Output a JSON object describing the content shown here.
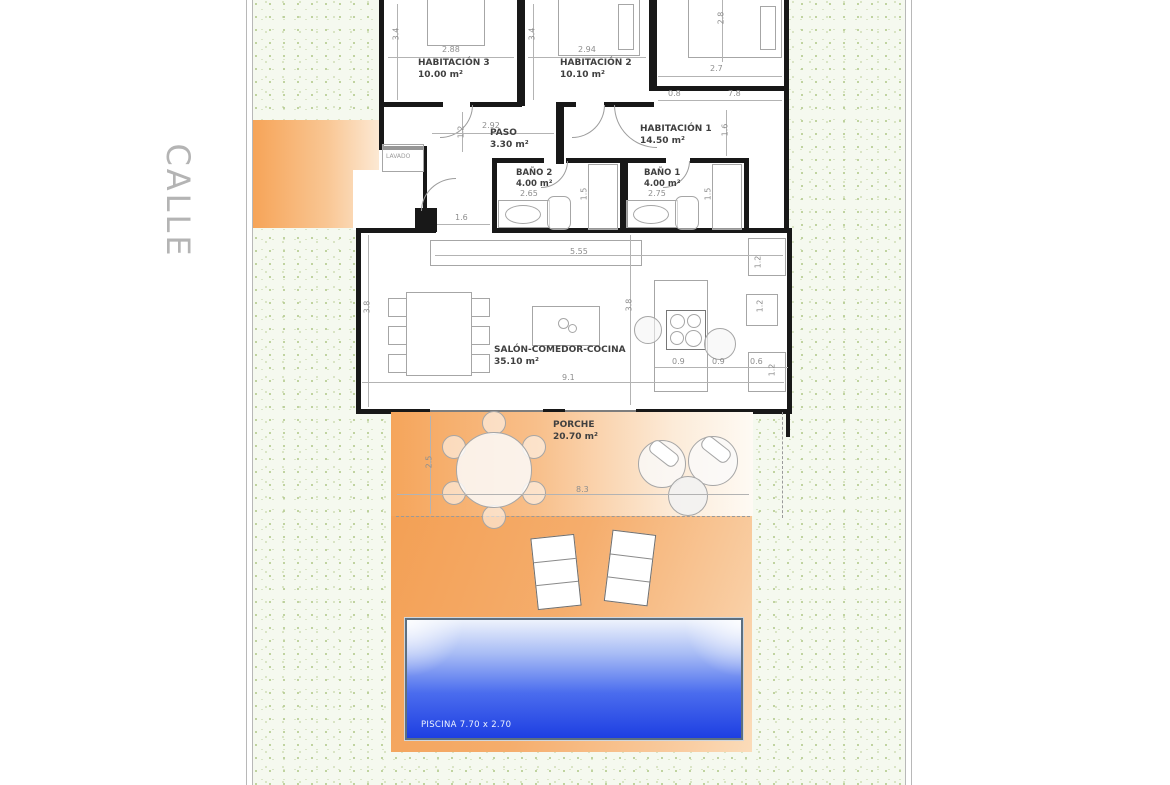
{
  "street": {
    "label": "CALLE"
  },
  "rooms": {
    "habitacion3": {
      "name": "HABITACIÓN 3",
      "area": "10.00 m²"
    },
    "habitacion2": {
      "name": "HABITACIÓN 2",
      "area": "10.10 m²"
    },
    "habitacion1": {
      "name": "HABITACIÓN 1",
      "area": "14.50 m²"
    },
    "paso": {
      "name": "PASO",
      "area": "3.30 m²"
    },
    "bano2": {
      "name": "BAÑO 2",
      "area": "4.00 m²"
    },
    "bano1": {
      "name": "BAÑO 1",
      "area": "4.00 m²"
    },
    "salon": {
      "name": "SALÓN-COMEDOR-COCINA",
      "area": "35.10 m²"
    },
    "porche": {
      "name": "PORCHE",
      "area": "20.70 m²"
    },
    "lavado": {
      "name": "LAVADO"
    }
  },
  "pool": {
    "label": "PISCINA 7.70 x 2.70"
  },
  "dims": {
    "hab3_h": "3.4",
    "hab3_w": "2.88",
    "hab2_h": "3.4",
    "hab2_w": "2.94",
    "hab1_top_h": "2.8",
    "hab1_top_w": "2.7",
    "corr_a": "0.8",
    "corr_b": "7.8",
    "hab1_v": "1.6",
    "paso_w": "2.92",
    "paso_v": "1.2",
    "hall_w": "1.6",
    "bano2_w": "2.65",
    "bano2_v": "1.5",
    "bano1_w": "2.75",
    "bano1_v": "1.5",
    "counter_w": "5.55",
    "salon_left_h": "3.8",
    "salon_mid_h": "3.8",
    "salon_w": "9.1",
    "right_v": "1.2",
    "niche": "1.2",
    "right_v2": "1.2",
    "k1": "0.9",
    "k2": "0.9",
    "k3": "0.6",
    "porch_h": "2.5",
    "porch_w": "8.3"
  },
  "colors": {
    "terrace_orange": "#f3a055",
    "pool_blue": "#1e3fe2",
    "garden_green": "#f5f9ef",
    "wall_black": "#181818",
    "street_gray": "#b4b4b4"
  }
}
